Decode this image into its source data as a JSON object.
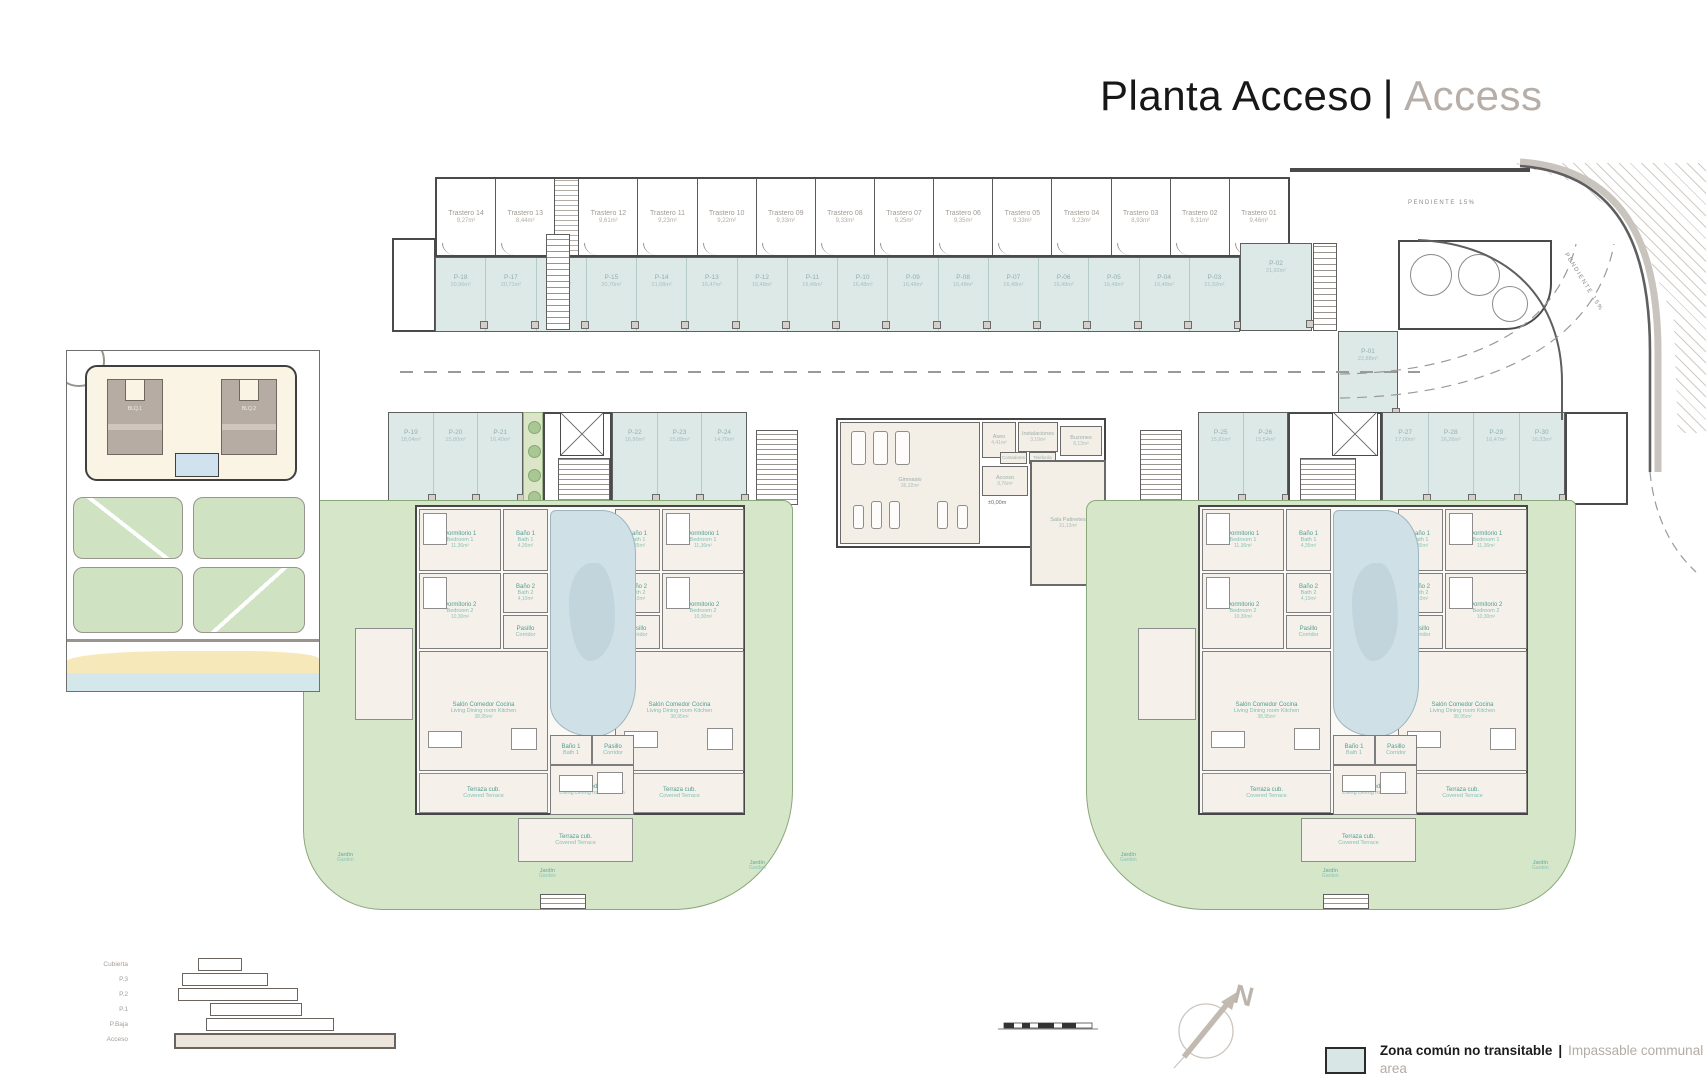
{
  "title": {
    "primary": "Planta Acceso",
    "separator": "|",
    "secondary": "Access"
  },
  "legend": {
    "label_es": "Zona común no transitable",
    "separator": "|",
    "label_en": "Impassable communal area",
    "swatch_color": "#d9e6e6"
  },
  "section_key": {
    "levels": [
      "Cubierta",
      "P.3",
      "P.2",
      "P.1",
      "P.Baja",
      "Acceso"
    ],
    "current": "Acceso"
  },
  "compass": {
    "label": "N"
  },
  "ramp": {
    "label": "PENDIENTE 15%",
    "label_curved": "PENDIENTE 15%"
  },
  "site_map": {
    "buildings": [
      "BLQ.1",
      "BLQ.2"
    ]
  },
  "storage_top": [
    {
      "name": "Trastero 14",
      "area": "9,27m²"
    },
    {
      "name": "Trastero 13",
      "area": "8,44m²"
    },
    {
      "name": "Trastero 12",
      "area": "9,61m²"
    },
    {
      "name": "Trastero 11",
      "area": "9,23m²"
    },
    {
      "name": "Trastero 10",
      "area": "9,22m²"
    },
    {
      "name": "Trastero 09",
      "area": "9,33m²"
    },
    {
      "name": "Trastero 08",
      "area": "9,33m²"
    },
    {
      "name": "Trastero 07",
      "area": "9,25m²"
    },
    {
      "name": "Trastero 06",
      "area": "9,35m²"
    },
    {
      "name": "Trastero 05",
      "area": "9,33m²"
    },
    {
      "name": "Trastero 04",
      "area": "9,23m²"
    },
    {
      "name": "Trastero 03",
      "area": "8,93m²"
    },
    {
      "name": "Trastero 02",
      "area": "9,31m²"
    },
    {
      "name": "Trastero 01",
      "area": "9,46m²"
    }
  ],
  "storage_mid_left": [
    {
      "name": "Trastero 15",
      "area": "7,51m²"
    },
    {
      "name": "Trastero 16",
      "area": "6,24m²"
    },
    {
      "name": "Trastero 17",
      "area": "8,51m²"
    },
    {
      "name": "Trastero 18",
      "area": "6,44m²"
    }
  ],
  "storage_mid_right": [
    {
      "name": "Trastero 19",
      "area": "7,51m²"
    },
    {
      "name": "Trastero 20",
      "area": "6,95m²"
    },
    {
      "name": "Trastero 21",
      "area": "8,59m²"
    },
    {
      "name": "Trastero 22",
      "area": "6,44m²"
    }
  ],
  "parking_top": [
    {
      "name": "P-18",
      "area": "20,96m²"
    },
    {
      "name": "P-17",
      "area": "20,71m²"
    },
    {
      "name": "P-16",
      "area": "21,84m²"
    },
    {
      "name": "P-15",
      "area": "20,70m²"
    },
    {
      "name": "P-14",
      "area": "21,68m²"
    },
    {
      "name": "P-13",
      "area": "16,47m²"
    },
    {
      "name": "P-12",
      "area": "16,48m²"
    },
    {
      "name": "P-11",
      "area": "16,48m²"
    },
    {
      "name": "P-10",
      "area": "16,48m²"
    },
    {
      "name": "P-09",
      "area": "16,48m²"
    },
    {
      "name": "P-08",
      "area": "16,48m²"
    },
    {
      "name": "P-07",
      "area": "16,48m²"
    },
    {
      "name": "P-06",
      "area": "16,48m²"
    },
    {
      "name": "P-05",
      "area": "16,48m²"
    },
    {
      "name": "P-04",
      "area": "16,48m²"
    },
    {
      "name": "P-03",
      "area": "21,92m²"
    }
  ],
  "parking_ramp": {
    "p02": {
      "name": "P-02",
      "area": "21,92m²"
    },
    "p01": {
      "name": "P-01",
      "area": "22,88m²"
    }
  },
  "parking_mid_left": [
    {
      "name": "P-19",
      "area": "18,04m²"
    },
    {
      "name": "P-20",
      "area": "15,80m²"
    },
    {
      "name": "P-21",
      "area": "16,40m²"
    }
  ],
  "parking_mid_left2": [
    {
      "name": "P-22",
      "area": "16,90m²"
    },
    {
      "name": "P-23",
      "area": "15,88m²"
    },
    {
      "name": "P-24",
      "area": "14,70m²"
    }
  ],
  "parking_mid_right": [
    {
      "name": "P-25",
      "area": "15,91m²"
    },
    {
      "name": "P-26",
      "area": "15,54m²"
    }
  ],
  "parking_mid_right2": [
    {
      "name": "P-27",
      "area": "17,00m²"
    },
    {
      "name": "P-28",
      "area": "16,26m²"
    },
    {
      "name": "P-29",
      "area": "16,47m²"
    },
    {
      "name": "P-30",
      "area": "16,33m²"
    }
  ],
  "central": {
    "gym": {
      "name": "Gimnasio",
      "area": "36,32m²"
    },
    "aseo": {
      "name": "Aseo",
      "area": "4,41m²"
    },
    "instal": {
      "name": "Instalaciones",
      "area": "3,19m²"
    },
    "buzones": {
      "name": "Buzones",
      "area": "8,13m²"
    },
    "cont1": {
      "name": "Contadores",
      "area": ""
    },
    "cont2": {
      "name": "Telefonía",
      "area": ""
    },
    "acceso": {
      "name": "Acceso",
      "area": "9,76m²"
    },
    "sala": {
      "name": "Sala Patinetes",
      "area": "31,13m²"
    },
    "level_mark": "±0,00m"
  },
  "apartment": {
    "dorm1": {
      "es": "Dormitorio 1",
      "en": "Bedroom 1",
      "area": "11,36m²"
    },
    "bath1": {
      "es": "Baño 1",
      "en": "Bath 1",
      "area": "4,35m²"
    },
    "dorm2": {
      "es": "Dormitorio 2",
      "en": "Bedroom 2",
      "area": "10,30m²"
    },
    "bath2": {
      "es": "Baño 2",
      "en": "Bath 2",
      "area": "4,10m²"
    },
    "pasillo": {
      "es": "Pasillo",
      "en": "Corridor",
      "area": "4,50m²"
    },
    "salon": {
      "es": "Salón Comedor Cocina",
      "en": "Living Dining room Kitchen",
      "area": "38,95m²"
    },
    "terraza": {
      "es": "Terraza cub.",
      "en": "Covered Terrace",
      "area": "12,50m²"
    },
    "jardin": {
      "es": "Jardín",
      "en": "Garden"
    }
  }
}
